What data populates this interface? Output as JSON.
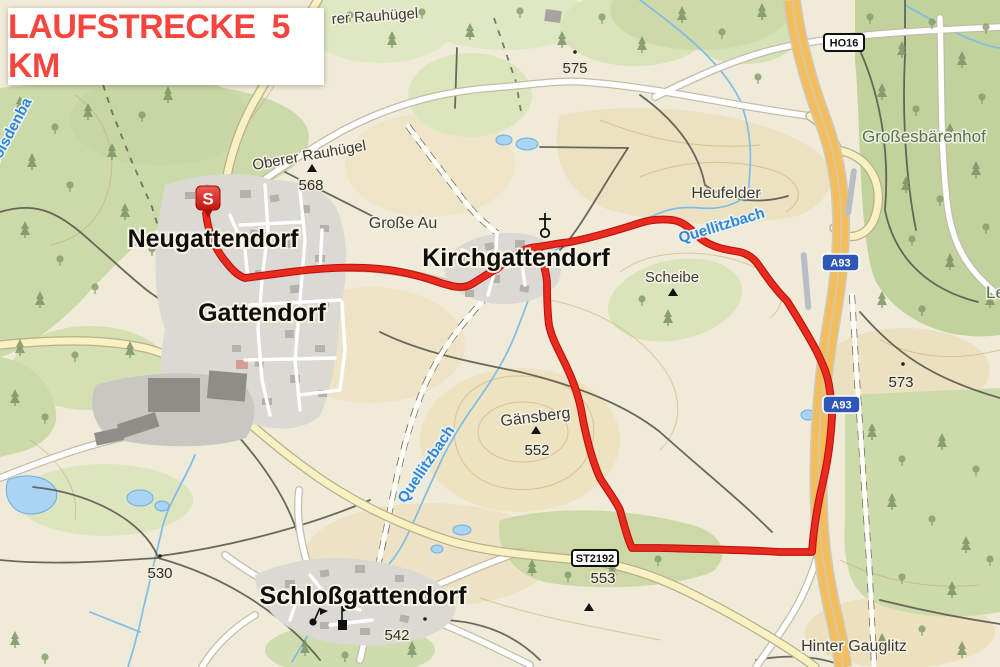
{
  "header": {
    "text": "LAUFSTRECKE 5 KM",
    "color": "#f4463e"
  },
  "map": {
    "towns": [
      {
        "name": "Neugattendorf"
      },
      {
        "name": "Gattendorf"
      },
      {
        "name": "Kirchgattendorf"
      },
      {
        "name": "Schloßgattendorf"
      }
    ],
    "places": [
      {
        "name": "Oberer Rauhügel"
      },
      {
        "name": "rer Rauhügel"
      },
      {
        "name": "Große Au"
      },
      {
        "name": "Heufelder"
      },
      {
        "name": "Scheibe"
      },
      {
        "name": "Gänsberg"
      },
      {
        "name": "Großesbärenhof"
      },
      {
        "name": "Le"
      },
      {
        "name": "Hinter Gauglitz"
      }
    ],
    "waters": [
      {
        "name": "Quellitzbach"
      },
      {
        "name": "Quellitzbach"
      },
      {
        "name": "Bolsdenba"
      }
    ],
    "elevations": [
      {
        "value": "575"
      },
      {
        "value": "568"
      },
      {
        "value": "573"
      },
      {
        "value": "552"
      },
      {
        "value": "553"
      },
      {
        "value": "530"
      },
      {
        "value": "542"
      }
    ],
    "road_refs": [
      {
        "ref": "HO16"
      },
      {
        "ref": "A93"
      },
      {
        "ref": "A93"
      },
      {
        "ref": "ST2192"
      }
    ],
    "route": {
      "start_label": "S",
      "color": "#e92a1f"
    }
  }
}
